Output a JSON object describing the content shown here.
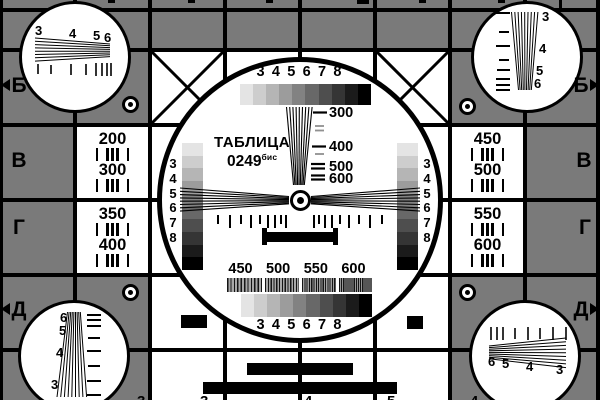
{
  "colors": {
    "background_gray": "#7a7a7a",
    "ink": "#000000",
    "paper": "#ffffff"
  },
  "center": {
    "title": "ТАБЛИЦА",
    "code": "0249",
    "code_sup": "бис",
    "top_scale_numbers": [
      "3",
      "4",
      "5",
      "6",
      "7",
      "8"
    ],
    "bottom_scale_numbers": [
      "3",
      "4",
      "5",
      "6",
      "7",
      "8"
    ],
    "left_gray_scale_numbers": [
      "3",
      "4",
      "5",
      "6",
      "7",
      "8"
    ],
    "right_gray_scale_numbers": [
      "3",
      "4",
      "5",
      "6",
      "7",
      "8"
    ],
    "resolution_labels": [
      "300",
      "400",
      "500",
      "600"
    ],
    "burst_labels": [
      "450",
      "500",
      "550",
      "600"
    ],
    "grayscale_steps": [
      "#e4e4e4",
      "#cdcdcd",
      "#b5b5b5",
      "#9c9c9c",
      "#828282",
      "#686868",
      "#4e4e4e",
      "#353535",
      "#1b1b1b",
      "#000000"
    ]
  },
  "left_panel": {
    "rows": [
      "200",
      "300",
      "350",
      "400"
    ]
  },
  "right_panel": {
    "rows": [
      "450",
      "500",
      "550",
      "600"
    ]
  },
  "row_letters": {
    "left": [
      "Б",
      "В",
      "Г",
      "Д"
    ],
    "right": [
      "Б",
      "В",
      "Г",
      "Д"
    ]
  },
  "corner_circles": {
    "top_left_numbers": [
      "3",
      "4",
      "5",
      "6"
    ],
    "top_right_numbers": [
      "3",
      "4",
      "5",
      "6"
    ],
    "bottom_left_numbers": [
      "6",
      "5",
      "4",
      "3"
    ],
    "bottom_right_numbers": [
      "6",
      "5",
      "4",
      "3"
    ]
  },
  "bottom_edge_digits": [
    "3",
    "3",
    "4",
    "5",
    "4"
  ]
}
